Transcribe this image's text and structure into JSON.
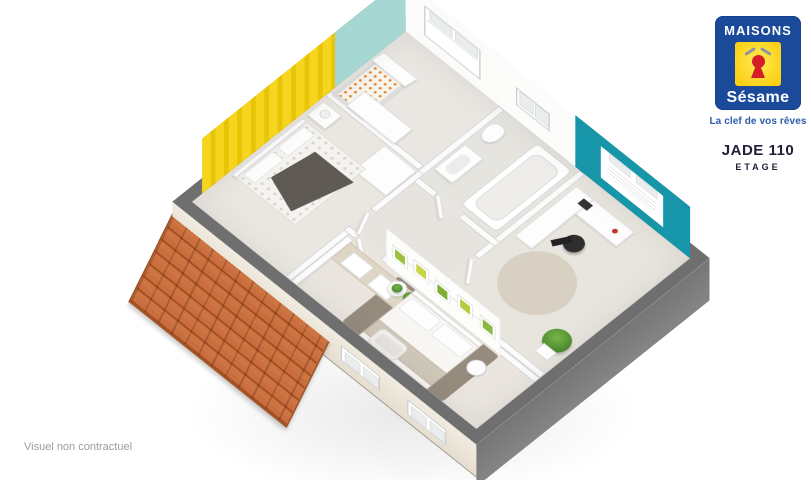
{
  "brand": {
    "name_top": "MAISONS",
    "name_script": "Sésame",
    "tagline": "La clef de vos rêves",
    "colors": {
      "blue": "#1b4a9b",
      "yellow": "#fcd31c",
      "red": "#d41f28"
    }
  },
  "title": {
    "model": "JADE 110",
    "level": "ETAGE"
  },
  "footer": {
    "disclaimer": "Visuel non contractuel"
  },
  "floorplan_colors": {
    "wall_cap_gray": "#6f6f6f",
    "floor_beige": "#e9e6e1",
    "facade_light": "#efe8dc",
    "facade_shadow_gray": "#7d7d7d",
    "roof_orange_tile": "#c96e3e",
    "office_accent_teal": "#1795a9",
    "nursery_accent_teal": "#a7d7d3",
    "bedroom_accent_yellow": "#f5d41e",
    "master_rug_taupe": "#968c7e"
  }
}
